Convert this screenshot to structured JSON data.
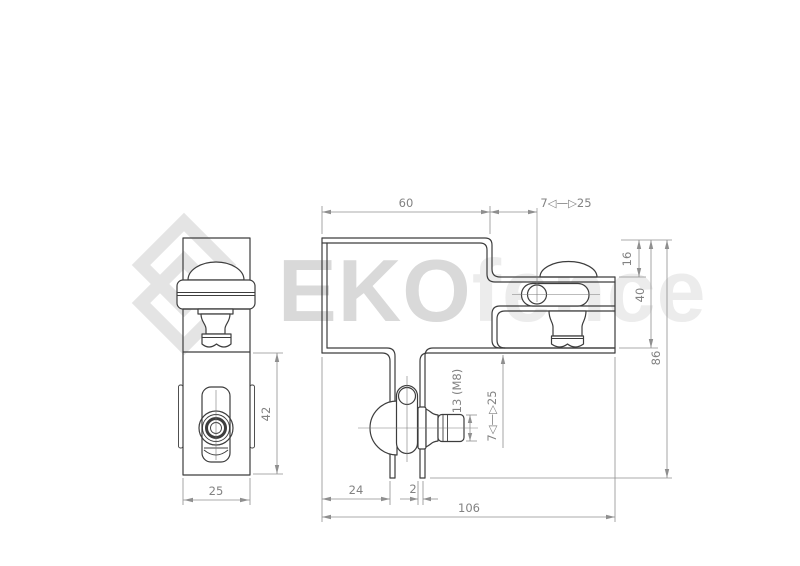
{
  "watermark": {
    "brand_bold": "EKO",
    "brand_light": "fence",
    "logo_icon": "diamond-logo"
  },
  "dimensions": {
    "top_width": "60",
    "top_adjust_range": "7◁—▷25",
    "flange_offset": "16",
    "body_height": "40",
    "total_height": "86",
    "leg_offset": "24",
    "leg_thickness": "2",
    "total_width": "106",
    "bolt_thread": "13 (M8)",
    "bolt_adjust_range": "7◁—▷25",
    "front_body_height": "42",
    "front_width": "25"
  },
  "colors": {
    "part_line": "#3d3d3d",
    "dimension_line": "#8f8f8f",
    "dimension_text": "#828282",
    "watermark_bold": "#d9d9d9",
    "watermark_light": "#ececec",
    "background": "#ffffff"
  }
}
